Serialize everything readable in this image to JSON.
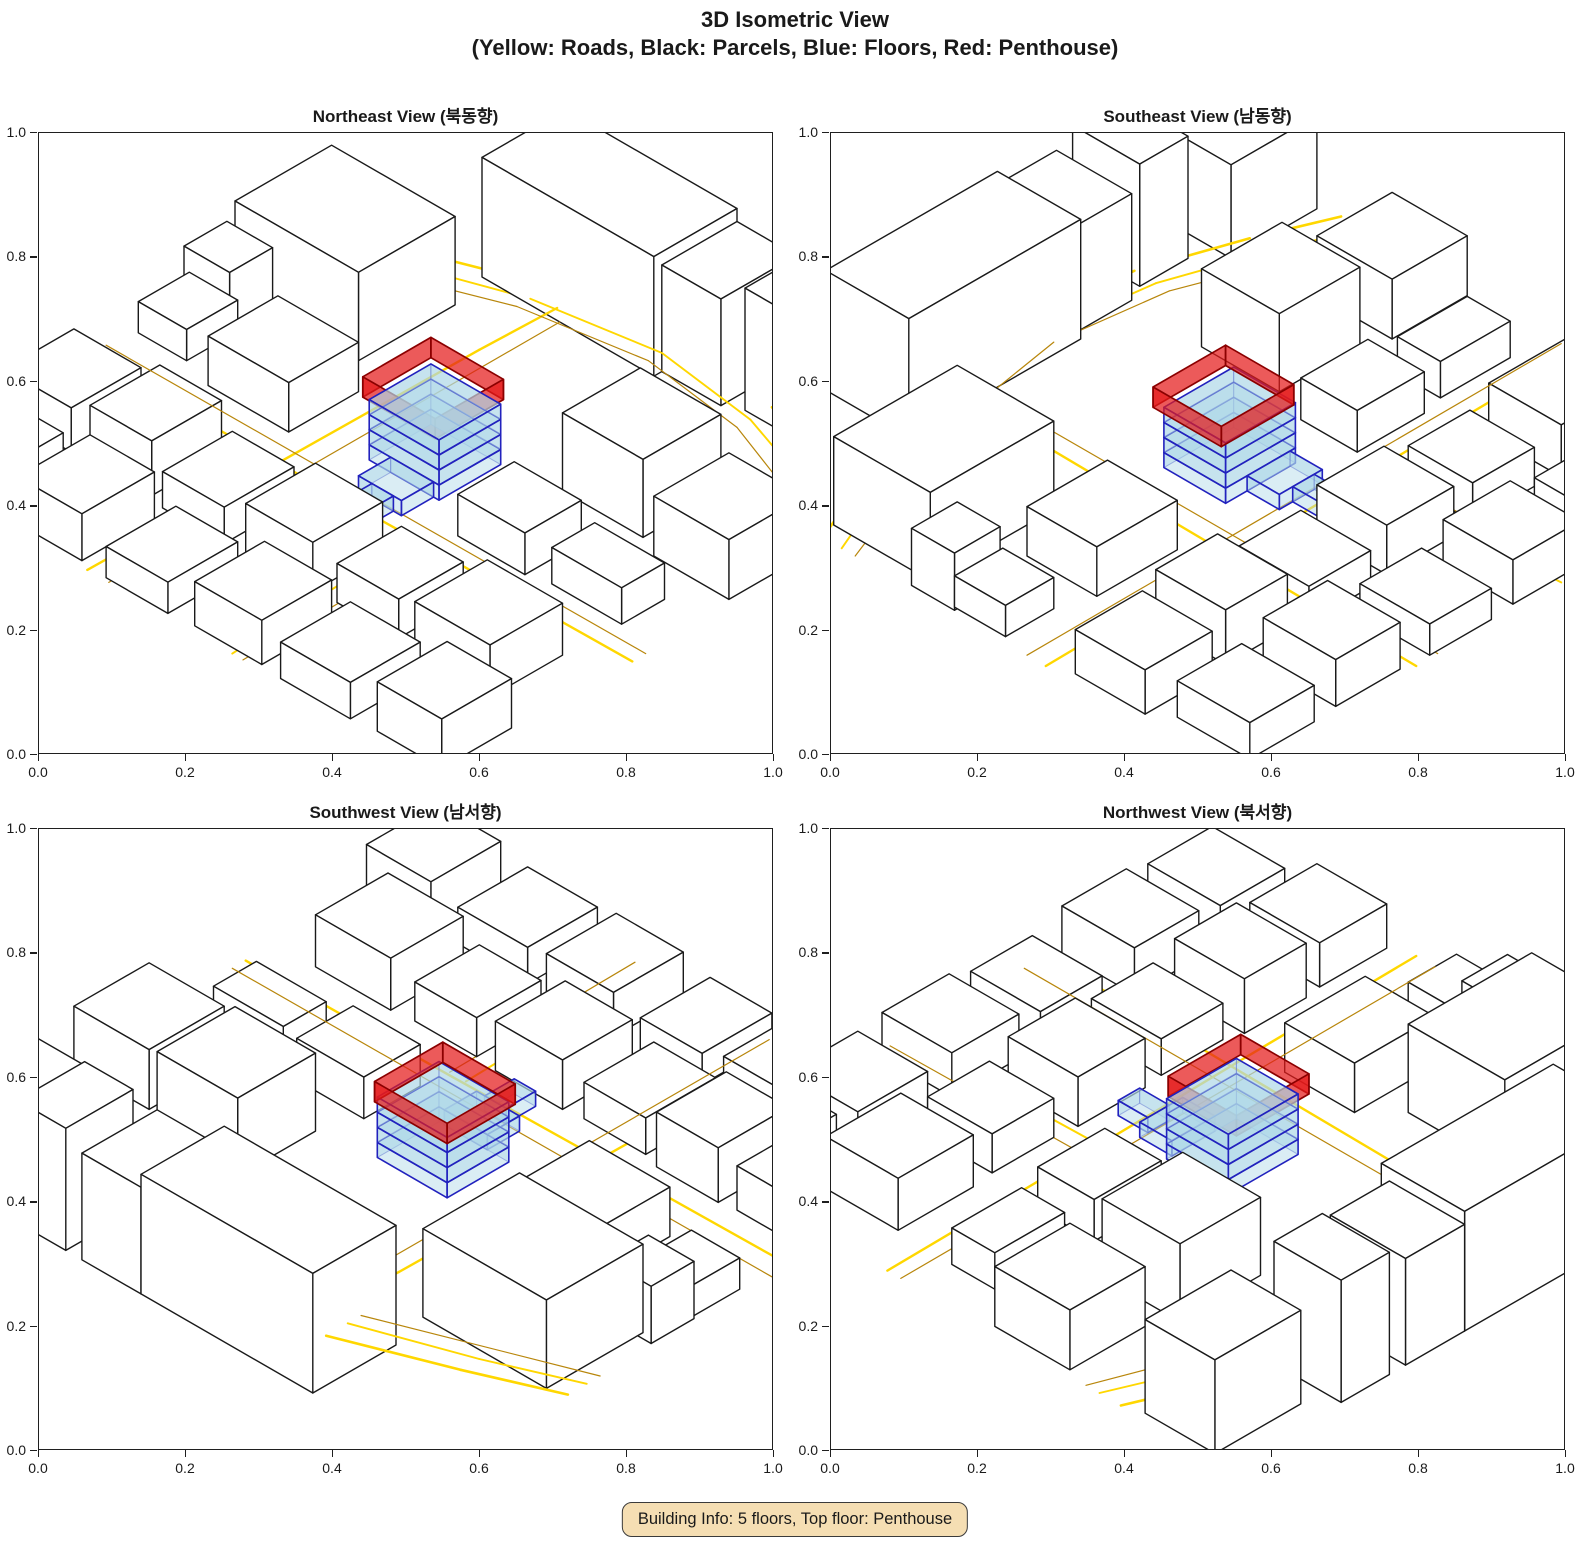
{
  "figure": {
    "title": "3D Isometric View",
    "subtitle": "(Yellow: Roads, Black: Parcels, Blue: Floors, Red: Penthouse)"
  },
  "subplots": [
    {
      "title": "Northeast View (북동향)"
    },
    {
      "title": "Southeast View (남동향)"
    },
    {
      "title": "Southwest View (남서향)"
    },
    {
      "title": "Northwest View (북서향)"
    }
  ],
  "axes": {
    "x_ticks": [
      "0.0",
      "0.2",
      "0.4",
      "0.6",
      "0.8",
      "1.0"
    ],
    "y_ticks": [
      "0.0",
      "0.2",
      "0.4",
      "0.6",
      "0.8",
      "1.0"
    ]
  },
  "footer": {
    "text": "Building Info: 5 floors, Top floor: Penthouse"
  },
  "building": {
    "floors": 5,
    "top_floor": "Penthouse"
  },
  "colors": {
    "road_primary": "#FFD700",
    "road_secondary": "#B8860B",
    "parcel_fill": "#FFFFFF",
    "parcel_edge": "#1A1A1A",
    "floor_fill": "#ADD8E6",
    "floor_edge": "#2222BE",
    "penthouse_fill": "#E41B1B",
    "penthouse_edge": "#8B0000",
    "info_bg": "#F5DEB3",
    "info_border": "#3B3B3B",
    "text": "#1A1A1A"
  }
}
